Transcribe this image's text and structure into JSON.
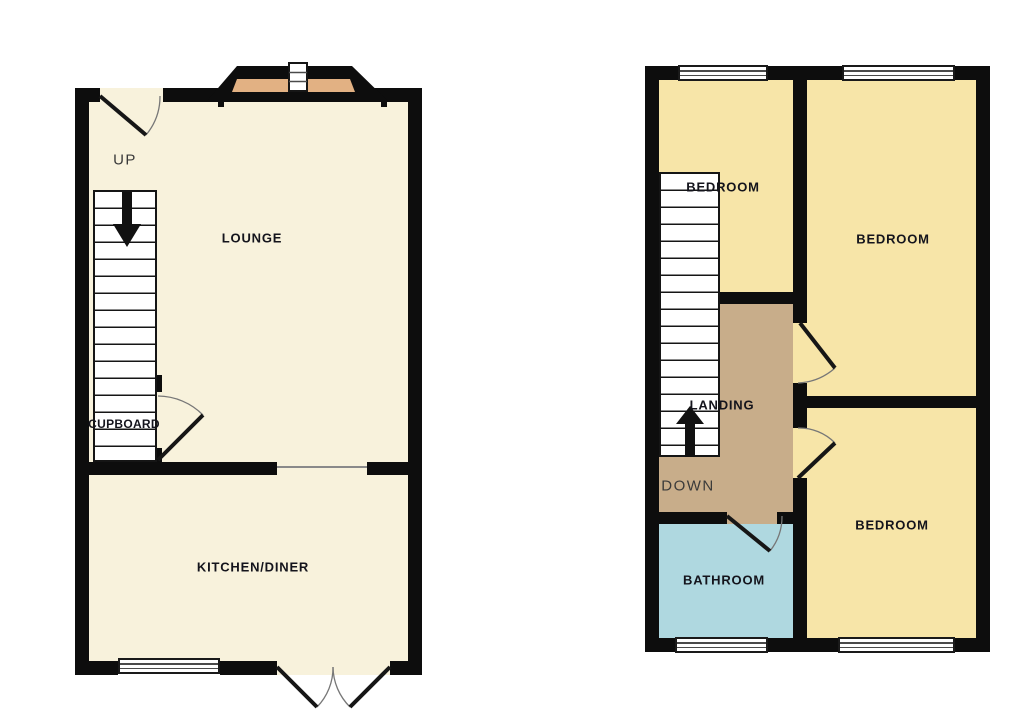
{
  "ground_floor": {
    "lounge_label": "LOUNGE",
    "kitchen_label": "KITCHEN/DINER",
    "cupboard_label": "CUPBOARD",
    "direction_label": "UP"
  },
  "first_floor": {
    "bedroom1_label": "BEDROOM",
    "bedroom2_label": "BEDROOM",
    "bedroom3_label": "BEDROOM",
    "landing_label": "LANDING",
    "bathroom_label": "BATHROOM",
    "direction_label": "DOWN"
  },
  "colors": {
    "cream": "#f8f2dc",
    "yellow": "#f7e5a8",
    "tan": "#c8ad8a",
    "blue": "#afd8e0",
    "sill": "#e2b183",
    "wall": "#0d0d0d",
    "label": "#14141c",
    "dir": "#3a3a3a",
    "arc": "#777777"
  }
}
